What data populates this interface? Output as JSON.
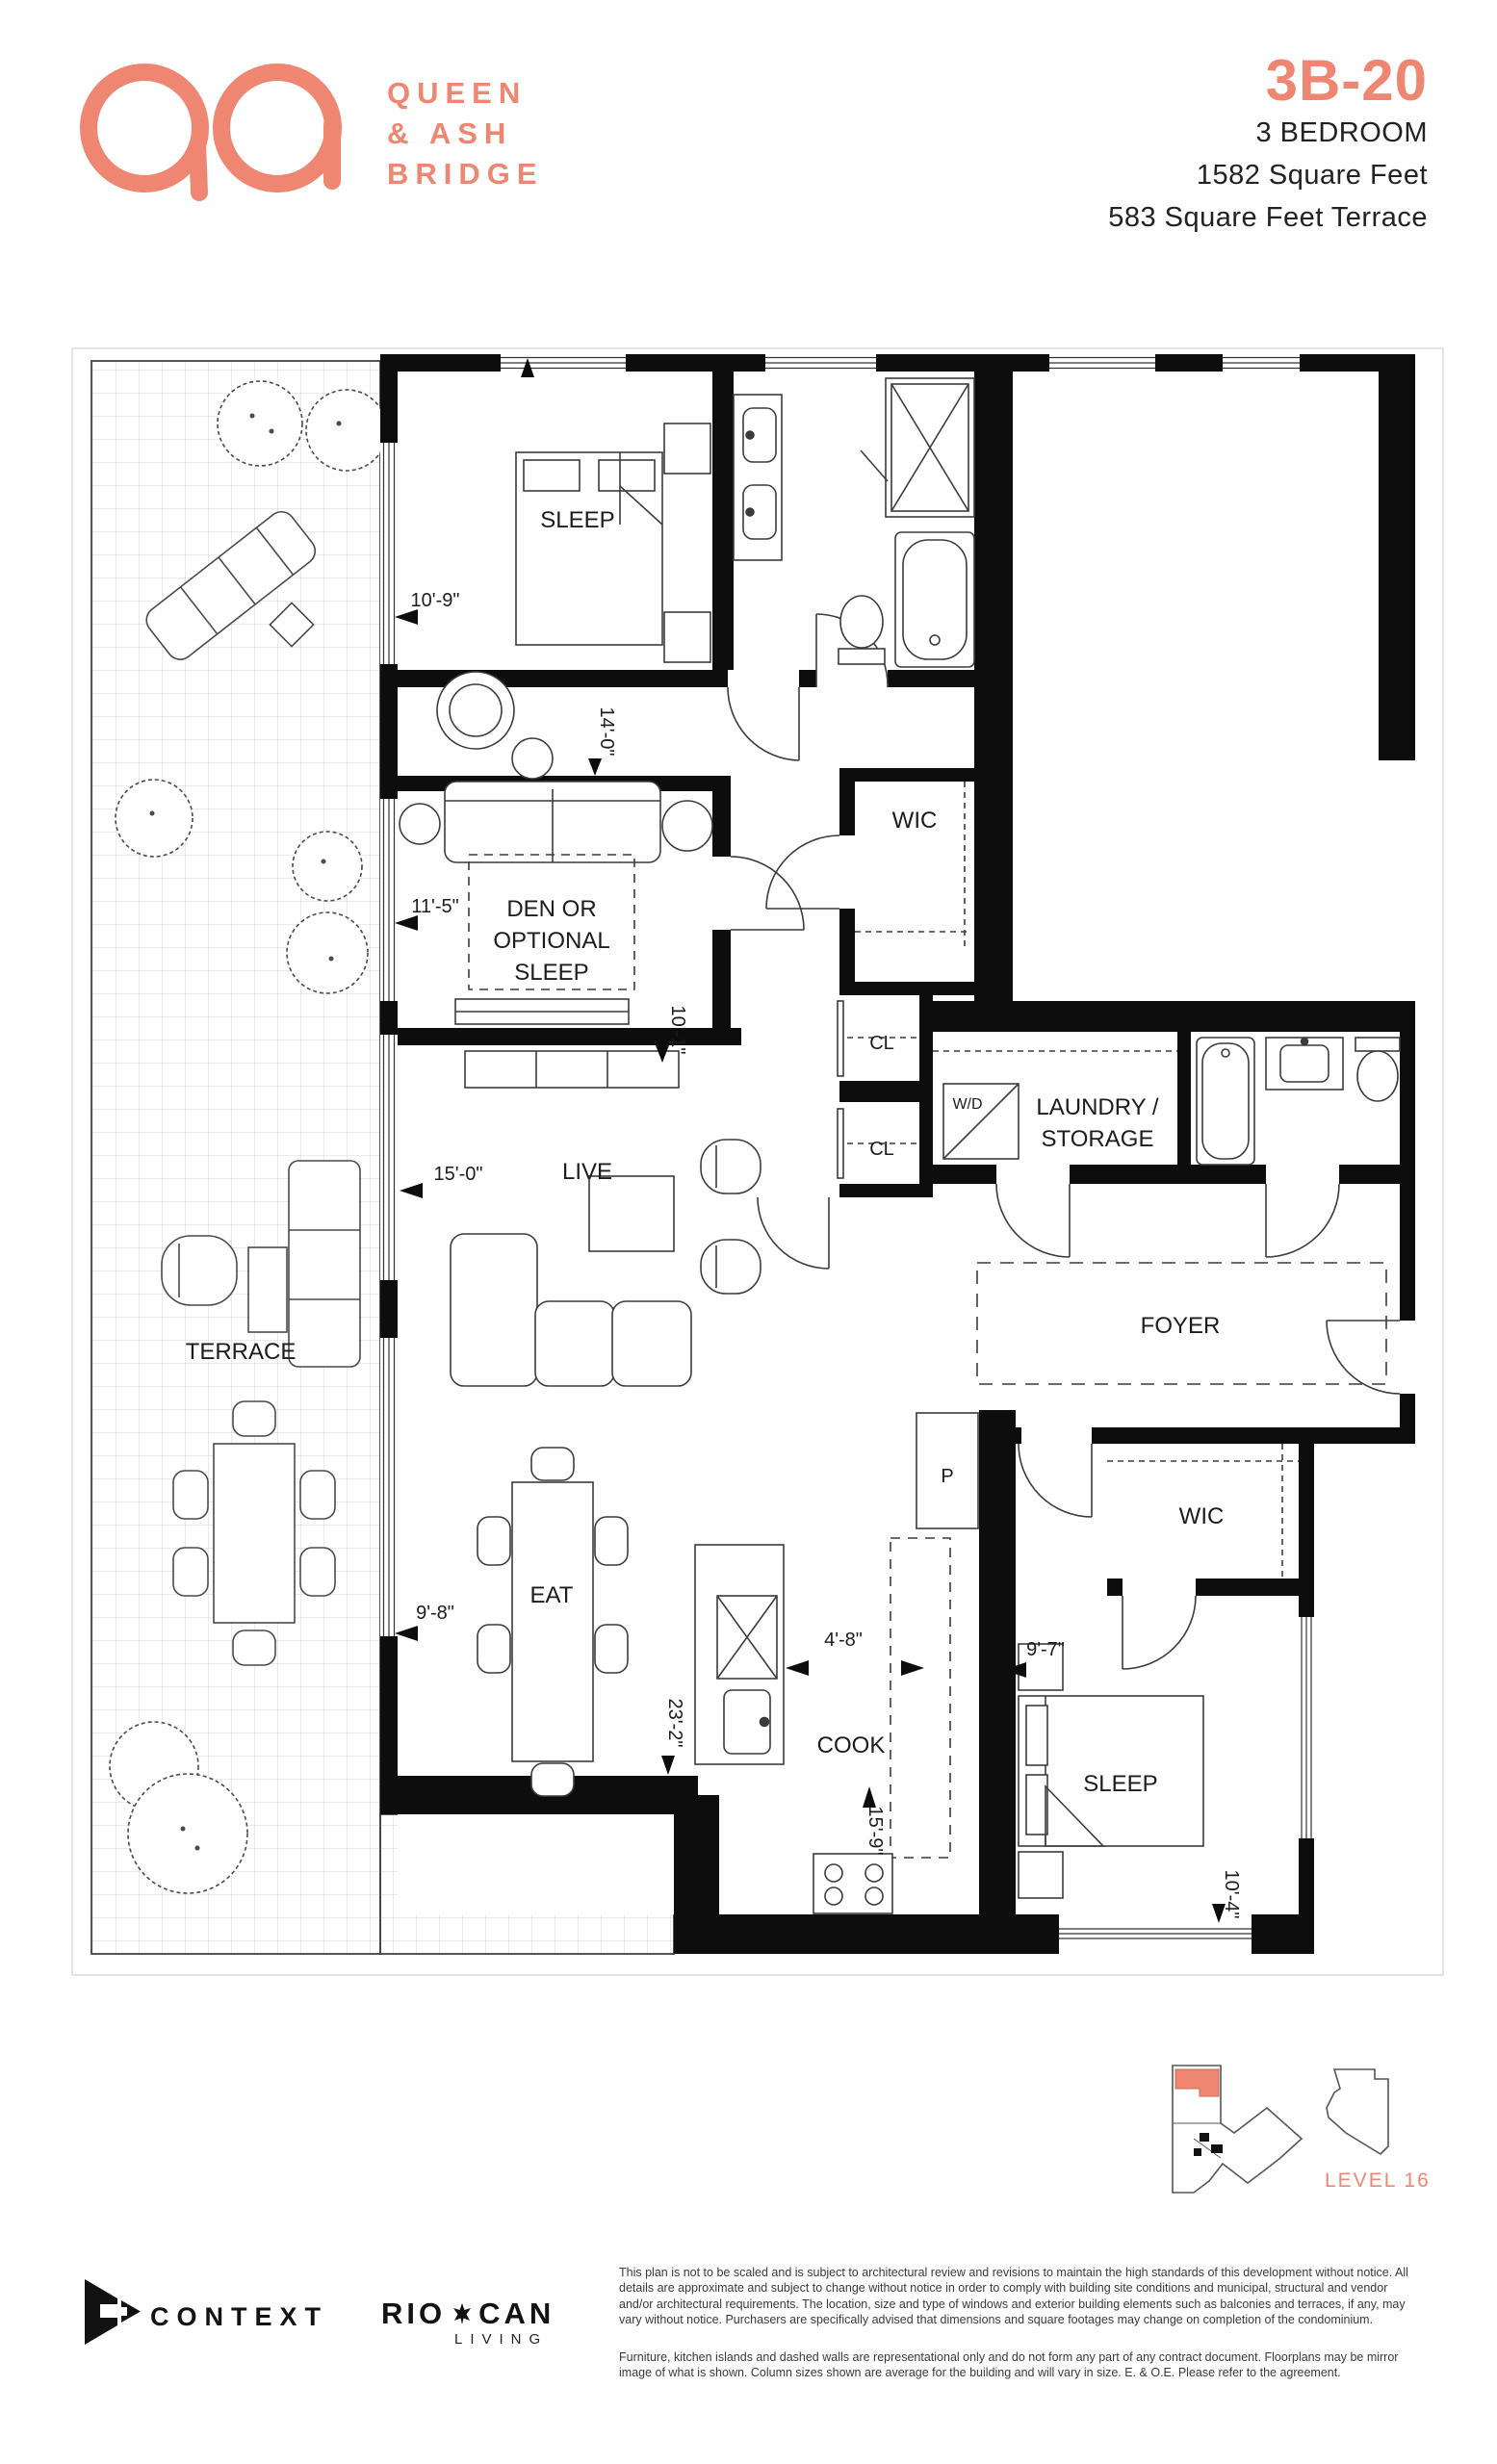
{
  "colors": {
    "accent": "#EF8672",
    "ink": "#1c1c1c",
    "wall": "#0d0d0d"
  },
  "header": {
    "brand_line1": "QUEEN",
    "brand_line2": "& ASH",
    "brand_line3": "BRIDGE",
    "unit_code": "3B-20",
    "unit_type": "3 BEDROOM",
    "unit_area": "1582 Square Feet",
    "terrace_area": "583 Square Feet Terrace"
  },
  "plan": {
    "rooms": {
      "sleep1": "SLEEP",
      "wic1": "WIC",
      "den1": "DEN OR",
      "den2": "OPTIONAL",
      "den3": "SLEEP",
      "cl1": "CL",
      "cl2": "CL",
      "wd": "W/D",
      "laundry1": "LAUNDRY /",
      "laundry2": "STORAGE",
      "foyer": "FOYER",
      "terrace": "TERRACE",
      "live": "LIVE",
      "eat": "EAT",
      "pantry": "P",
      "wic2": "WIC",
      "cook": "COOK",
      "sleep2": "SLEEP"
    },
    "dims": {
      "sleep1": "10'-9\"",
      "den_top": "14'-0\"",
      "den": "11'-5\"",
      "media": "10'-1\"",
      "live": "15'-0\"",
      "eat": "9'-8\"",
      "aisle": "4'-8\"",
      "depth": "23'-2\"",
      "cook": "15'-9\"",
      "sleep2": "9'-7\"",
      "sleep2_depth": "10'-4\""
    }
  },
  "keyplan": {
    "level": "LEVEL 16"
  },
  "footer": {
    "developer": "CONTEXT",
    "brand_rio": "RIO",
    "brand_can": "CAN",
    "brand_living": "LIVING",
    "disclaimer1": "This plan is not to be scaled and is subject to architectural review and revisions to maintain the high standards of this development without notice. All details are approximate and subject to change without notice in order to comply with building site conditions and municipal, structural and vendor and/or architectural requirements. The location, size and type of windows and exterior building elements such as balconies and terraces, if any, may vary without notice. Purchasers are specifically advised that dimensions and square footages may change on completion of the condominium.",
    "disclaimer2": "Furniture, kitchen islands and dashed walls are representational only and do not form any part of any contract document. Floorplans may be mirror image of what is shown. Column sizes shown are average for the building and will vary in size. E. & O.E. Please refer to the agreement."
  }
}
